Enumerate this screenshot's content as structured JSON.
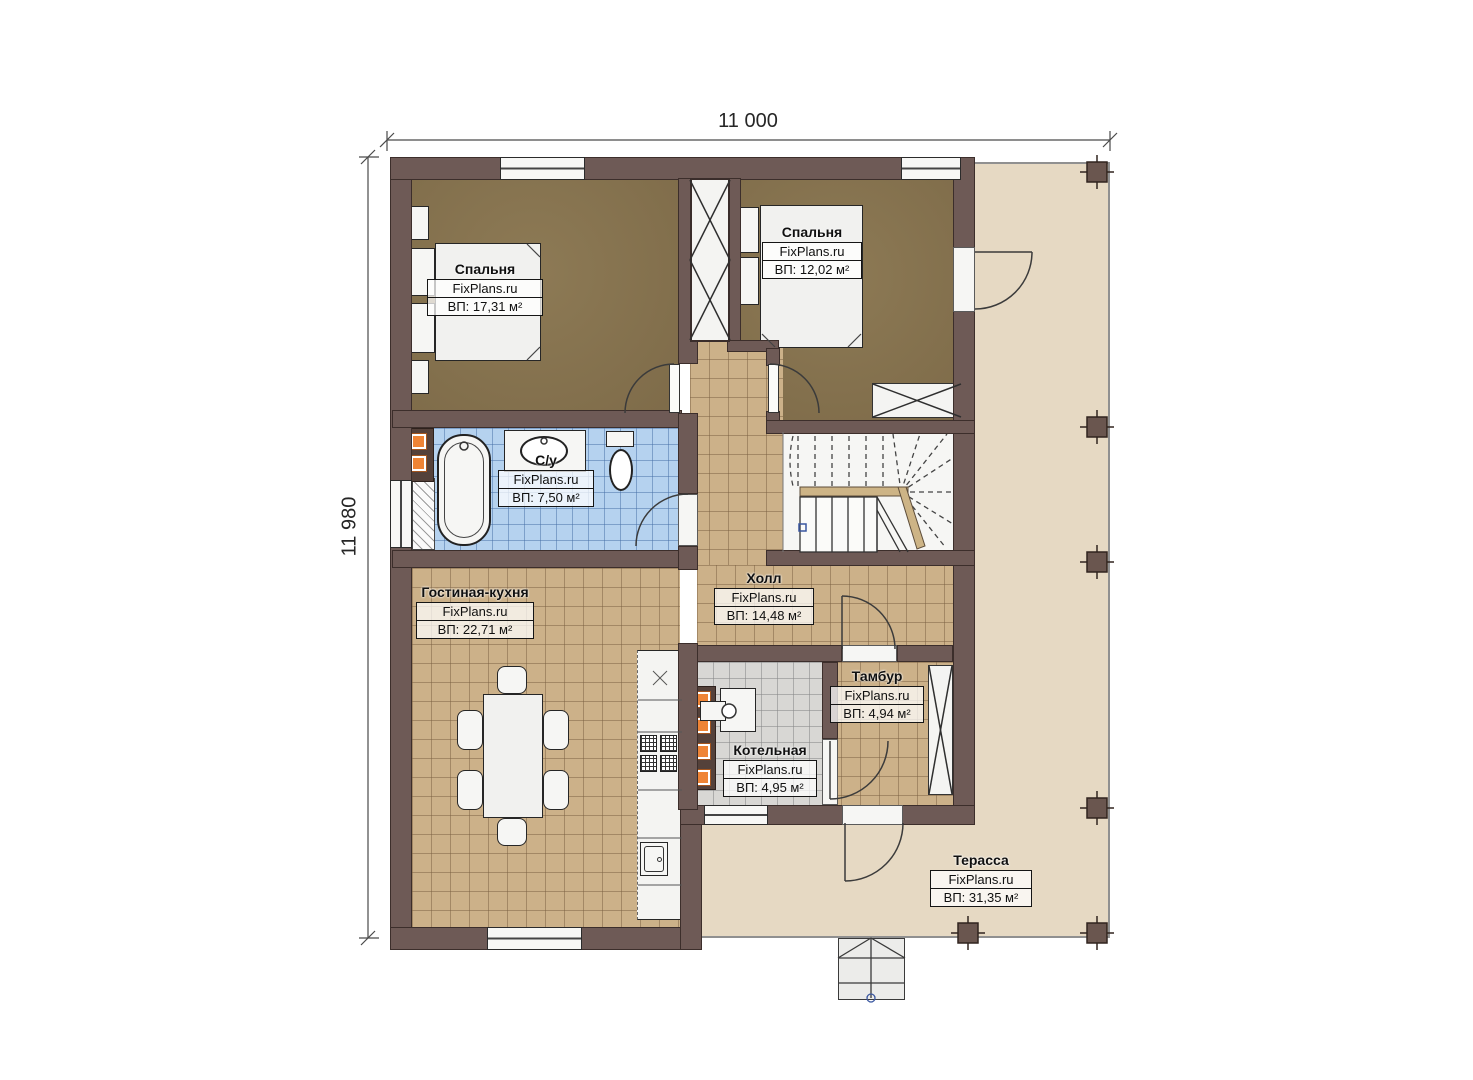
{
  "plan": {
    "brand": "FixPlans.ru",
    "dim_top": "11 000",
    "dim_left": "11 980",
    "rooms": [
      {
        "id": "bedroom1",
        "name": "Спальня",
        "area": "ВП: 17,31 м²"
      },
      {
        "id": "bedroom2",
        "name": "Спальня",
        "area": "ВП: 12,02 м²"
      },
      {
        "id": "bathroom",
        "name": "С/у",
        "area": "ВП: 7,50 м²"
      },
      {
        "id": "living-kitchen",
        "name": "Гостиная-кухня",
        "area": "ВП: 22,71 м²"
      },
      {
        "id": "hall",
        "name": "Холл",
        "area": "ВП: 14,48 м²"
      },
      {
        "id": "tambour",
        "name": "Тамбур",
        "area": "ВП: 4,94 м²"
      },
      {
        "id": "boiler",
        "name": "Котельная",
        "area": "ВП: 4,95 м²"
      },
      {
        "id": "terrace",
        "name": "Терасса",
        "area": "ВП: 31,35 м²"
      }
    ]
  }
}
